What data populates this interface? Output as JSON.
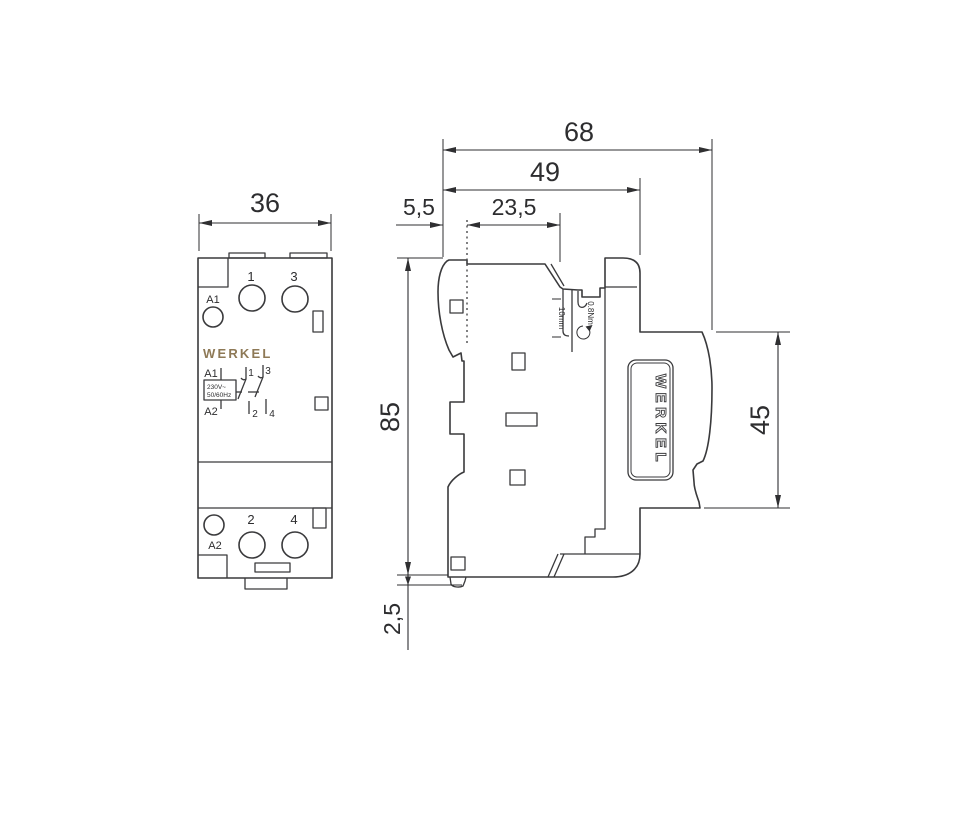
{
  "title": "WERKEL modular contactor dimensional drawing",
  "front_view": {
    "dims": {
      "width": "36"
    },
    "top_terminals": {
      "coil": "A1",
      "left": "1",
      "right": "3"
    },
    "bottom_terminals": {
      "coil": "A2",
      "left": "2",
      "right": "4"
    },
    "brand": "WERKEL",
    "label": {
      "coil_top": "A1",
      "coil_bottom": "A2",
      "voltage": "230V~",
      "frequency": "50/60Hz",
      "contact1": "1",
      "contact2": "2",
      "contact3": "3",
      "contact4": "4"
    }
  },
  "side_view": {
    "dims": {
      "total_depth": "68",
      "body_depth": "49",
      "terminal_offset": "23,5",
      "rail_offset": "5,5",
      "height": "85",
      "front_height": "45",
      "rail_protrusion": "2,5"
    },
    "annotations": {
      "strip_length": "10mm",
      "torque": "0.8Nm"
    },
    "logo": "WERKEL"
  },
  "colors": {
    "line": "#3a3a3c",
    "text": "#2d2d2f",
    "brand_gold": "#8e7956",
    "background": "#ffffff"
  }
}
